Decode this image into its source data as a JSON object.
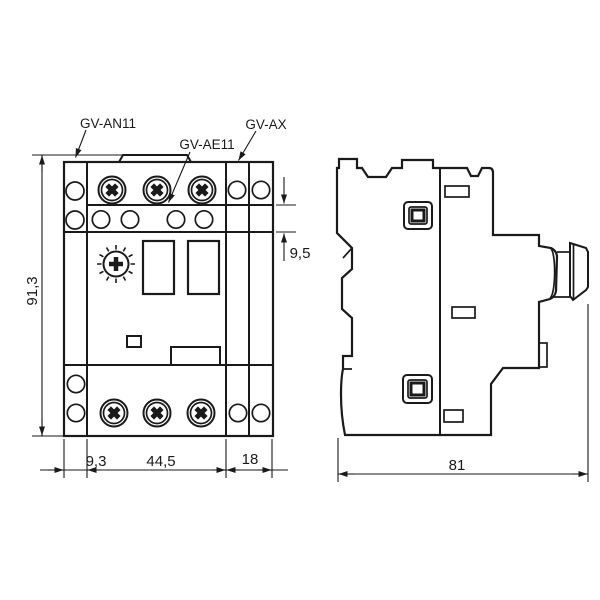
{
  "front_view": {
    "labels": {
      "left_module": "GV-AN11",
      "front_module": "GV-AE11",
      "side_module": "GV-AX"
    },
    "dimensions": {
      "overall_height_mm": "91,3",
      "left_module_width_mm": "9,3",
      "body_width_mm": "44,5",
      "side_module_width_mm": "18",
      "front_module_height_mm": "9,5"
    }
  },
  "side_view": {
    "dimensions": {
      "overall_depth_mm": "81"
    }
  },
  "colors": {
    "line": "#1a1a1a",
    "background": "#ffffff"
  }
}
